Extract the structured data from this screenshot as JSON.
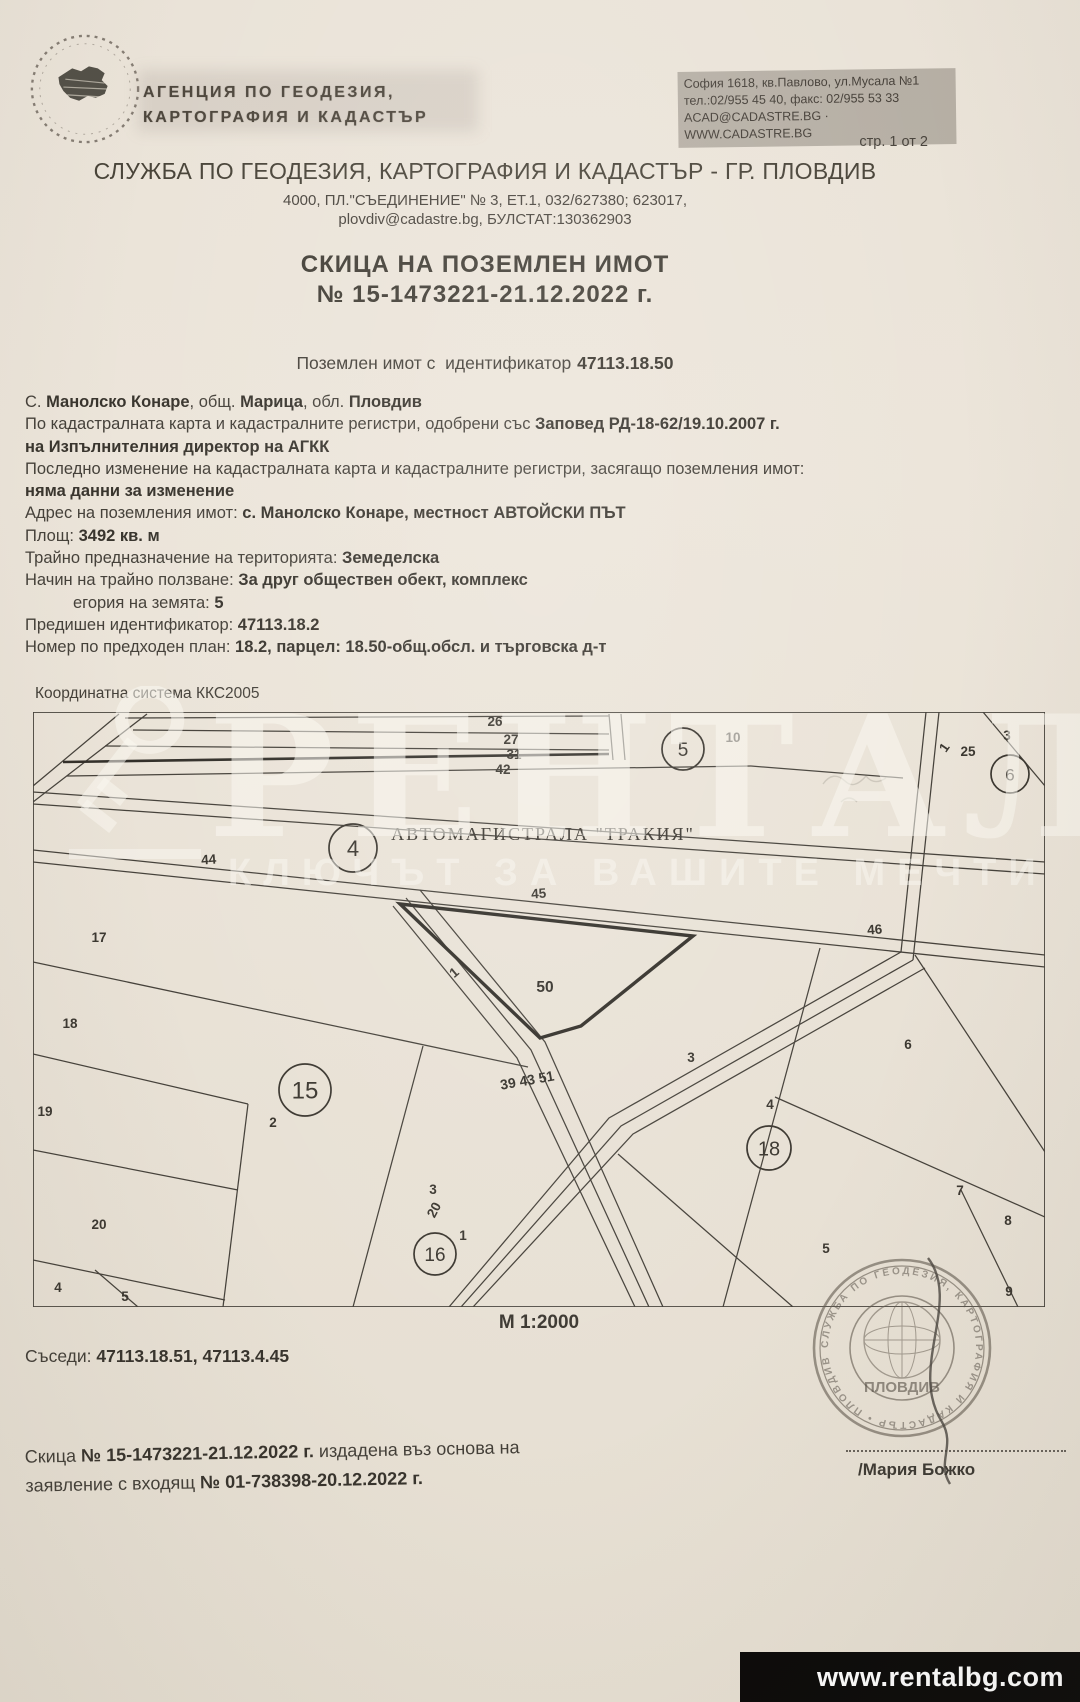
{
  "letterhead": {
    "agency_name_line1": "АГЕНЦИЯ ПО ГЕОДЕЗИЯ,",
    "agency_name_line2": "КАРТОГРАФИЯ И КАДАСТЪР",
    "hq_address": "София 1618, кв.Павлово, ул.Мусала №1",
    "hq_phone": "тел.:02/955 45 40, факс: 02/955 53 33",
    "hq_web": "ACAD@CADASTRE.BG · WWW.CADASTRE.BG",
    "page_number": "стр. 1 от 2",
    "office_title": "СЛУЖБА ПО ГЕОДЕЗИЯ, КАРТОГРАФИЯ И КАДАСТЪР - ГР. ПЛОВДИВ",
    "office_address": "4000, ПЛ.\"СЪЕДИНЕНИЕ\" № 3, ЕТ.1, 032/627380; 623017,",
    "office_email": "plovdiv@cadastre.bg, БУЛСТАТ:130362903"
  },
  "title": {
    "line1": "СКИЦА НА ПОЗЕМЛЕН ИМОТ",
    "line2": "№ 15-1473221-21.12.2022 г.",
    "subtitle_prefix": "Поземлен имот с  идентификатор",
    "subtitle_id": "47113.18.50"
  },
  "details": {
    "lines": [
      {
        "indent": false,
        "segments": [
          {
            "t": "С. ",
            "b": false
          },
          {
            "t": "Манолско Конаре",
            "b": true
          },
          {
            "t": ", общ. ",
            "b": false
          },
          {
            "t": "Марица",
            "b": true
          },
          {
            "t": ", обл. ",
            "b": false
          },
          {
            "t": "Пловдив",
            "b": true
          }
        ]
      },
      {
        "indent": false,
        "segments": [
          {
            "t": "По кадастралната карта и кадастралните регистри, одобрени със ",
            "b": false
          },
          {
            "t": "Заповед РД-18-62/19.10.2007 г.",
            "b": true
          }
        ]
      },
      {
        "indent": false,
        "segments": [
          {
            "t": "на Изпълнителния директор на АГКК",
            "b": true
          }
        ]
      },
      {
        "indent": false,
        "segments": [
          {
            "t": "Последно изменение на кадастралната карта и кадастралните регистри, засягащо поземления имот:",
            "b": false
          }
        ]
      },
      {
        "indent": false,
        "segments": [
          {
            "t": "няма данни за изменение",
            "b": true
          }
        ]
      },
      {
        "indent": false,
        "segments": [
          {
            "t": "Адрес на поземления имот: ",
            "b": false
          },
          {
            "t": "с. Манолско Конаре, местност АВТОЙСКИ ПЪТ",
            "b": true
          }
        ]
      },
      {
        "indent": false,
        "segments": [
          {
            "t": "Площ: ",
            "b": false
          },
          {
            "t": "3492 кв. м",
            "b": true
          }
        ]
      },
      {
        "indent": false,
        "segments": [
          {
            "t": "Трайно предназначение на територията: ",
            "b": false
          },
          {
            "t": "Земеделска",
            "b": true
          }
        ]
      },
      {
        "indent": false,
        "segments": [
          {
            "t": "Начин на трайно ползване: ",
            "b": false
          },
          {
            "t": "За друг обществен обект, комплекс",
            "b": true
          }
        ]
      },
      {
        "indent": true,
        "segments": [
          {
            "t": "егория на земята: ",
            "b": false
          },
          {
            "t": "5",
            "b": true
          }
        ]
      },
      {
        "indent": false,
        "segments": [
          {
            "t": "Предишен идентификатор: ",
            "b": false
          },
          {
            "t": "47113.18.2",
            "b": true
          }
        ]
      },
      {
        "indent": false,
        "segments": [
          {
            "t": "Номер по предходен план: ",
            "b": false
          },
          {
            "t": "18.2, парцел: 18.50-общ.обсл. и търговска д-т",
            "b": true
          }
        ]
      }
    ]
  },
  "map": {
    "coord_system": "Координатна система ККС2005",
    "scale_label": "М 1:2000",
    "highway_label": "АВТОМАГИСТРАЛА \"ТРАКИЯ\"",
    "ink": "#46423b",
    "bold_ink": "#33302a",
    "border": [
      0,
      0,
      1012,
      0,
      1012,
      595,
      0,
      595
    ],
    "lines": [
      [
        92,
        6,
        576,
        4
      ],
      [
        100,
        18,
        576,
        22
      ],
      [
        72,
        34,
        576,
        38
      ],
      [
        34,
        64,
        718,
        54
      ],
      [
        718,
        54,
        870,
        66
      ],
      [
        576,
        2,
        580,
        48
      ],
      [
        588,
        2,
        592,
        48
      ],
      [
        86,
        2,
        0,
        74
      ],
      [
        114,
        2,
        0,
        90
      ],
      [
        950,
        0,
        1012,
        74
      ],
      [
        893,
        0,
        868,
        240
      ],
      [
        906,
        0,
        880,
        248
      ],
      [
        0,
        80,
        1012,
        150
      ],
      [
        0,
        92,
        1012,
        162
      ],
      [
        0,
        138,
        1012,
        243
      ],
      [
        0,
        150,
        1012,
        255
      ],
      [
        387,
        178,
        512,
        330,
        630,
        595
      ],
      [
        373,
        186,
        498,
        338,
        616,
        595
      ],
      [
        360,
        194,
        484,
        346,
        602,
        595
      ],
      [
        868,
        240,
        576,
        406,
        416,
        595
      ],
      [
        880,
        248,
        588,
        414,
        428,
        595
      ],
      [
        892,
        256,
        600,
        422,
        440,
        595
      ],
      [
        787,
        236,
        690,
        595
      ],
      [
        882,
        243,
        1012,
        440
      ],
      [
        742,
        385,
        1012,
        505
      ],
      [
        928,
        478,
        985,
        595
      ],
      [
        585,
        442,
        760,
        595
      ],
      [
        0,
        250,
        495,
        355
      ],
      [
        0,
        342,
        215,
        392
      ],
      [
        215,
        392,
        190,
        595
      ],
      [
        0,
        438,
        205,
        478
      ],
      [
        0,
        548,
        192,
        588
      ],
      [
        62,
        558,
        105,
        595
      ],
      [
        390,
        334,
        320,
        595
      ]
    ],
    "emphasis_line": [
      30,
      50,
      576,
      42
    ],
    "bold_parcel": [
      367,
      192,
      660,
      224,
      548,
      314,
      507,
      326
    ],
    "subject_parcel_label": {
      "t": "50",
      "x": 512,
      "y": 280
    },
    "road_label": {
      "t": "39 43 51",
      "x": 495,
      "y": 373,
      "rot": -10
    },
    "labels": [
      {
        "t": "26",
        "x": 462,
        "y": 14
      },
      {
        "t": "27",
        "x": 478,
        "y": 32
      },
      {
        "t": "31",
        "x": 481,
        "y": 47
      },
      {
        "t": "42",
        "x": 470,
        "y": 62
      },
      {
        "t": "10",
        "x": 700,
        "y": 30
      },
      {
        "t": "1",
        "x": 915,
        "y": 38,
        "rot": -55
      },
      {
        "t": "25",
        "x": 935,
        "y": 44
      },
      {
        "t": "3",
        "x": 974,
        "y": 28
      },
      {
        "t": "44",
        "x": 176,
        "y": 152,
        "rot": -4
      },
      {
        "t": "45",
        "x": 506,
        "y": 186,
        "rot": -4
      },
      {
        "t": "46",
        "x": 842,
        "y": 222,
        "rot": -4
      },
      {
        "t": "17",
        "x": 66,
        "y": 230
      },
      {
        "t": "18",
        "x": 37,
        "y": 316
      },
      {
        "t": "19",
        "x": 12,
        "y": 404
      },
      {
        "t": "2",
        "x": 240,
        "y": 415
      },
      {
        "t": "3",
        "x": 400,
        "y": 482
      },
      {
        "t": "1",
        "x": 424,
        "y": 264,
        "rot": -40
      },
      {
        "t": "20",
        "x": 405,
        "y": 500,
        "rot": -62
      },
      {
        "t": "20",
        "x": 66,
        "y": 517
      },
      {
        "t": "4",
        "x": 25,
        "y": 580
      },
      {
        "t": "5",
        "x": 92,
        "y": 589
      },
      {
        "t": "1",
        "x": 430,
        "y": 528
      },
      {
        "t": "3",
        "x": 658,
        "y": 350
      },
      {
        "t": "6",
        "x": 875,
        "y": 337
      },
      {
        "t": "4",
        "x": 737,
        "y": 397
      },
      {
        "t": "7",
        "x": 927,
        "y": 483
      },
      {
        "t": "8",
        "x": 975,
        "y": 513
      },
      {
        "t": "5",
        "x": 793,
        "y": 541
      },
      {
        "t": "9",
        "x": 976,
        "y": 584
      }
    ],
    "circles": [
      {
        "t": "5",
        "x": 650,
        "y": 37,
        "r": 21
      },
      {
        "t": "6",
        "x": 977,
        "y": 62,
        "r": 19
      },
      {
        "t": "4",
        "x": 320,
        "y": 136,
        "r": 24
      },
      {
        "t": "15",
        "x": 272,
        "y": 378,
        "r": 26
      },
      {
        "t": "16",
        "x": 402,
        "y": 542,
        "r": 21
      },
      {
        "t": "18",
        "x": 736,
        "y": 436,
        "r": 22
      }
    ]
  },
  "watermark": {
    "brand": "РЕНТАЛ",
    "tagline": "КЛЮЧЪТ ЗА ВАШИТЕ МЕЧТИ"
  },
  "footer": {
    "neighbors_label": "Съседи:",
    "neighbors_value": "47113.18.51, 47113.4.45",
    "issue_pre1": "Скица ",
    "issue_bold1": "№ 15-1473221-21.12.2022 г.",
    "issue_post1": " издадена въз основа на",
    "issue_pre2": "заявление с входящ ",
    "issue_bold2": "№ 01-738398-20.12.2022 г.",
    "signer": "/Мария Божко",
    "stamp_city": "ПЛОВДИВ",
    "stamp_ring": "СЛУЖБА ПО ГЕОДЕЗИЯ, КАРТОГРАФИЯ И КАДАСТЪР • ПЛОВДИВ •",
    "site": "www.rentalbg.com"
  }
}
